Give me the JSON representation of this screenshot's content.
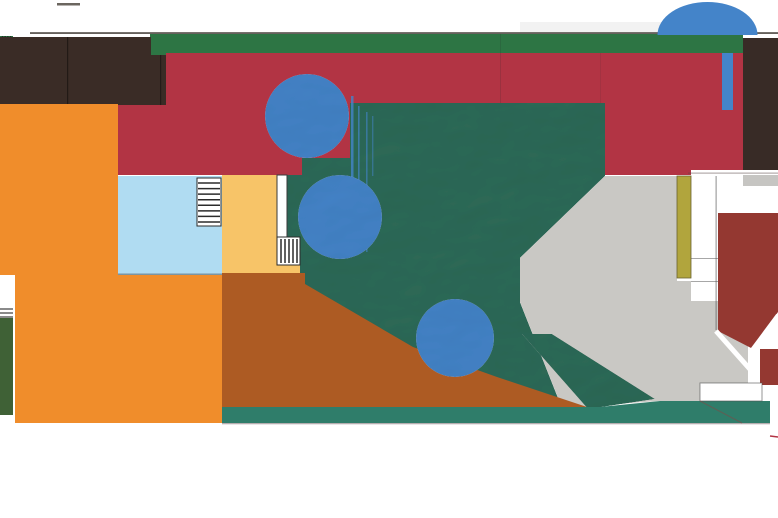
{
  "meta": {
    "description": "architectural-site-plan",
    "width": 778,
    "height": 518,
    "background": "#ffffff"
  },
  "palette": {
    "background": "#ffffff",
    "boundary_line": "#55504b",
    "roof_green": "#2d7544",
    "terrace_red": "#b23444",
    "dark_roof": "#3a2c26",
    "court_orange": "#f08d2b",
    "pool_blue": "#b0dcf2",
    "terrace_yellow": "#f7c468",
    "earth_brown": "#ad5b23",
    "lawn_teal": "#2e6b58",
    "south_strip_teal": "#2f7d6a",
    "hedge_green": "#3f6136",
    "plaza_gray": "#c9c8c4",
    "brick_red": "#943831",
    "olive_wall": "#b1a53d",
    "canopy_blue": "#4484c9"
  },
  "shapes": [
    {
      "name": "top-edge-tick",
      "type": "rect",
      "x": 57,
      "y": 3,
      "w": 23,
      "h": 2.5,
      "fill": "#6b665f"
    },
    {
      "name": "sky-shadow-wash",
      "type": "rect",
      "x": 520,
      "y": 22,
      "w": 145,
      "h": 11,
      "fill": "rgba(130,130,130,0.10)"
    },
    {
      "name": "top-boundary-line",
      "type": "rect",
      "x": 30,
      "y": 32.2,
      "w": 748,
      "h": 1.7,
      "fill": "#55504b"
    },
    {
      "name": "green-roof-strip",
      "type": "rect",
      "x": 150,
      "y": 34,
      "w": 593,
      "h": 19,
      "fill": "#2d7544"
    },
    {
      "name": "left-green-stripe-block",
      "type": "rect",
      "x": 0,
      "y": 36,
      "w": 13,
      "h": 17,
      "fill": "#2d7544"
    },
    {
      "name": "left-green-stripe-hatch",
      "type": "hatch",
      "x": 1.5,
      "y": 36,
      "w": 10,
      "h": 17,
      "count": 4,
      "dir": "v",
      "stroke": "#1e3326",
      "sw": 1.4
    },
    {
      "name": "red-terrace",
      "type": "rect",
      "x": 117,
      "y": 53,
      "w": 626,
      "h": 122,
      "fill": "#b23444"
    },
    {
      "name": "red-terrace-seam-1",
      "type": "rect",
      "x": 500,
      "y": 34,
      "w": 1,
      "h": 141,
      "fill": "rgba(40,40,40,0.16)"
    },
    {
      "name": "red-terrace-seam-2",
      "type": "rect",
      "x": 600,
      "y": 53,
      "w": 1,
      "h": 122,
      "fill": "rgba(40,40,40,0.10)"
    },
    {
      "name": "dark-roof-block",
      "type": "rect",
      "x": 0,
      "y": 37,
      "w": 166,
      "h": 68,
      "fill": "#3a2c26"
    },
    {
      "name": "dark-roof-seam-1",
      "type": "rect",
      "x": 67,
      "y": 37,
      "w": 1.2,
      "h": 68,
      "fill": "rgba(0,0,0,0.4)"
    },
    {
      "name": "dark-roof-seam-2",
      "type": "rect",
      "x": 160,
      "y": 37,
      "w": 1.2,
      "h": 68,
      "fill": "rgba(0,0,0,0.35)"
    },
    {
      "name": "green-square-vent",
      "type": "rect",
      "x": 151,
      "y": 37,
      "w": 15,
      "h": 18,
      "fill": "#2d7544"
    },
    {
      "name": "orange-court-upper",
      "type": "rect",
      "x": 0,
      "y": 104,
      "w": 118,
      "h": 171,
      "fill": "#f08d2b"
    },
    {
      "name": "orange-court-lower",
      "type": "rect",
      "x": 15,
      "y": 275,
      "w": 207,
      "h": 148,
      "fill": "#f08d2b"
    },
    {
      "name": "west-notch-white",
      "type": "rect",
      "x": 0,
      "y": 277,
      "w": 15,
      "h": 146,
      "fill": "#ffffff"
    },
    {
      "name": "west-notch-stairs",
      "type": "hatch",
      "x": 0,
      "y": 308,
      "w": 13,
      "h": 10,
      "count": 3,
      "dir": "h",
      "stroke": "#4a4a4a",
      "sw": 1.3
    },
    {
      "name": "west-green-hedge",
      "type": "rect",
      "x": 0,
      "y": 318,
      "w": 13,
      "h": 97,
      "fill": "#3f6136"
    },
    {
      "name": "building-court-white",
      "type": "rect",
      "x": 691,
      "y": 170,
      "w": 87,
      "h": 238,
      "fill": "#ffffff"
    },
    {
      "name": "building-red-eave-line",
      "type": "rect",
      "x": 688,
      "y": 172.6,
      "w": 90,
      "h": 1,
      "fill": "rgba(90,70,70,0.55)"
    },
    {
      "name": "building-gray-ledge",
      "type": "rect",
      "x": 743,
      "y": 175,
      "w": 35,
      "h": 11,
      "fill": "#c6c5c2"
    },
    {
      "name": "northeast-dark-block",
      "type": "rect",
      "x": 743,
      "y": 38,
      "w": 35,
      "h": 132,
      "fill": "#382b26"
    },
    {
      "name": "blue-banner",
      "type": "rect",
      "x": 722,
      "y": 53,
      "w": 11,
      "h": 57,
      "fill": "#4484c9"
    },
    {
      "name": "park-lawn",
      "type": "polygon",
      "points": [
        [
          350,
          103
        ],
        [
          605,
          103
        ],
        [
          605,
          176
        ],
        [
          520,
          258
        ],
        [
          520,
          302
        ],
        [
          562,
          408
        ],
        [
          222,
          408
        ],
        [
          222,
          273
        ],
        [
          287,
          273
        ],
        [
          287,
          175
        ],
        [
          302,
          175
        ],
        [
          302,
          158
        ],
        [
          350,
          158
        ]
      ],
      "fill": "#2e6b58",
      "filter": "emboss"
    },
    {
      "name": "plaza-gray",
      "type": "polygon",
      "points": [
        [
          605,
          176
        ],
        [
          677,
          176
        ],
        [
          677,
          281
        ],
        [
          691,
          281
        ],
        [
          691,
          301
        ],
        [
          748,
          301
        ],
        [
          748,
          383
        ],
        [
          700,
          383
        ],
        [
          700,
          401
        ],
        [
          658,
          401
        ],
        [
          562,
          408
        ],
        [
          520,
          302
        ],
        [
          520,
          258
        ]
      ],
      "fill": "#c9c8c4"
    },
    {
      "name": "lawn-diagonal-band",
      "type": "polygon",
      "points": [
        [
          522,
          334
        ],
        [
          552,
          334
        ],
        [
          655,
          399
        ],
        [
          588,
          409
        ]
      ],
      "fill": "#2e6b58",
      "filter": "emboss"
    },
    {
      "name": "earth-brown",
      "type": "polygon",
      "points": [
        [
          222,
          273
        ],
        [
          305,
          273
        ],
        [
          305,
          284
        ],
        [
          413,
          347
        ],
        [
          497,
          377
        ],
        [
          590,
          408
        ],
        [
          222,
          408
        ]
      ],
      "fill": "#ad5b23"
    },
    {
      "name": "south-teal-strip",
      "type": "polygon",
      "points": [
        [
          222,
          407
        ],
        [
          600,
          407
        ],
        [
          660,
          401
        ],
        [
          770,
          401
        ],
        [
          770,
          423
        ],
        [
          222,
          423
        ]
      ],
      "fill": "#2f7d6a"
    },
    {
      "name": "south-strip-edge",
      "type": "rect",
      "x": 222,
      "y": 423,
      "w": 548,
      "h": 1.3,
      "fill": "rgba(120,105,110,0.55)"
    },
    {
      "name": "pool",
      "type": "rect",
      "x": 118,
      "y": 176,
      "w": 104,
      "h": 99,
      "fill": "#b0dcf2"
    },
    {
      "name": "pool-south-edge",
      "type": "rect",
      "x": 118,
      "y": 273.6,
      "w": 104,
      "h": 1.2,
      "fill": "rgba(60,60,60,0.55)"
    },
    {
      "name": "stair-north",
      "type": "rect",
      "x": 197,
      "y": 178,
      "w": 24,
      "h": 48,
      "fill": "#ffffff",
      "stroke": "#2b2b2b",
      "sw": 1
    },
    {
      "name": "stair-north-treads",
      "type": "hatch",
      "x": 198,
      "y": 182,
      "w": 22,
      "h": 41,
      "count": 8,
      "dir": "h",
      "stroke": "#2b2b2b",
      "sw": 1.5
    },
    {
      "name": "yellow-terrace",
      "type": "rect",
      "x": 222,
      "y": 175,
      "w": 56,
      "h": 98,
      "fill": "#f7c468"
    },
    {
      "name": "yellow-under-stair",
      "type": "rect",
      "x": 277,
      "y": 264,
      "w": 23,
      "h": 9,
      "fill": "#f7c468"
    },
    {
      "name": "white-wall-bar",
      "type": "rect",
      "x": 277,
      "y": 175,
      "w": 10,
      "h": 62,
      "fill": "#ffffff",
      "stroke": "#3a3a3a",
      "sw": 1
    },
    {
      "name": "stair-east",
      "type": "rect",
      "x": 277,
      "y": 237,
      "w": 23,
      "h": 28,
      "fill": "#ffffff",
      "stroke": "#2b2b2b",
      "sw": 1
    },
    {
      "name": "stair-east-treads",
      "type": "hatch",
      "x": 280,
      "y": 239,
      "w": 18,
      "h": 24,
      "count": 5,
      "dir": "v",
      "stroke": "#2b2b2b",
      "sw": 1.5
    },
    {
      "name": "olive-wall",
      "type": "rect",
      "x": 677,
      "y": 176,
      "w": 14,
      "h": 102,
      "fill": "#b1a53d",
      "stroke": "#6a6330",
      "sw": 0.8
    },
    {
      "name": "column-line-v",
      "type": "rect",
      "x": 715.6,
      "y": 176,
      "w": 1,
      "h": 154,
      "fill": "rgba(80,80,80,0.65)"
    },
    {
      "name": "column-line-h1",
      "type": "rect",
      "x": 691,
      "y": 258,
      "w": 27,
      "h": 1,
      "fill": "rgba(80,80,80,0.5)"
    },
    {
      "name": "column-line-h2",
      "type": "rect",
      "x": 691,
      "y": 281,
      "w": 27,
      "h": 1,
      "fill": "rgba(80,80,80,0.5)"
    },
    {
      "name": "roof-brick-main",
      "type": "polygon",
      "points": [
        [
          718,
          213
        ],
        [
          778,
          213
        ],
        [
          778,
          312
        ],
        [
          753,
          349
        ],
        [
          718,
          331
        ]
      ],
      "fill": "#943831"
    },
    {
      "name": "roof-ridge-1",
      "type": "line",
      "x1": 716,
      "y1": 331,
      "x2": 764,
      "y2": 385,
      "stroke": "#ffffff",
      "sw": 5
    },
    {
      "name": "roof-ridge-2",
      "type": "line",
      "x1": 752,
      "y1": 350,
      "x2": 778,
      "y2": 315,
      "stroke": "#ffffff",
      "sw": 4
    },
    {
      "name": "roof-ridge-3",
      "type": "line",
      "x1": 760,
      "y1": 386,
      "x2": 778,
      "y2": 358,
      "stroke": "#ffffff",
      "sw": 4
    },
    {
      "name": "roof-brick-east",
      "type": "rect",
      "x": 760,
      "y": 349,
      "w": 18,
      "h": 36,
      "fill": "#943831"
    },
    {
      "name": "roof-white-band",
      "type": "rect",
      "x": 700,
      "y": 383,
      "w": 62,
      "h": 18,
      "fill": "#ffffff",
      "stroke": "rgba(80,80,80,0.6)",
      "sw": 1
    },
    {
      "name": "roof-edge-line-1",
      "type": "line",
      "x1": 700,
      "y1": 401,
      "x2": 742,
      "y2": 423,
      "stroke": "rgba(150,60,60,0.45)",
      "sw": 1
    },
    {
      "name": "roof-edge-line-2",
      "type": "line",
      "x1": 770,
      "y1": 436,
      "x2": 778,
      "y2": 437,
      "stroke": "#b23444",
      "sw": 1.4
    },
    {
      "name": "dome-canopy",
      "type": "path",
      "d": "M 657.5 35 A 50 33 0 0 1 757.5 35 Z",
      "fill": "#4484c9"
    },
    {
      "name": "paint-drip-1",
      "type": "rect",
      "x": 351,
      "y": 96,
      "w": 2.5,
      "h": 150,
      "fill": "rgba(68,132,201,0.8)"
    },
    {
      "name": "paint-drip-2",
      "type": "rect",
      "x": 358,
      "y": 106,
      "w": 1.6,
      "h": 145,
      "fill": "rgba(68,132,201,0.7)"
    },
    {
      "name": "paint-drip-3",
      "type": "rect",
      "x": 366,
      "y": 112,
      "w": 1.6,
      "h": 140,
      "fill": "rgba(68,132,201,0.6)"
    },
    {
      "name": "paint-drip-4",
      "type": "rect",
      "x": 372,
      "y": 116,
      "w": 1.4,
      "h": 60,
      "fill": "rgba(68,132,201,0.5)"
    },
    {
      "name": "tree-canopy-north",
      "type": "circle",
      "cx": 307,
      "cy": 116,
      "r": 42,
      "fill": "#4484c9",
      "filter": "emboss"
    },
    {
      "name": "tree-canopy-mid",
      "type": "circle",
      "cx": 340,
      "cy": 217,
      "r": 42,
      "fill": "#4484c9",
      "filter": "emboss"
    },
    {
      "name": "tree-canopy-south",
      "type": "circle",
      "cx": 455,
      "cy": 338,
      "r": 39,
      "fill": "#4484c9",
      "filter": "emboss"
    }
  ]
}
